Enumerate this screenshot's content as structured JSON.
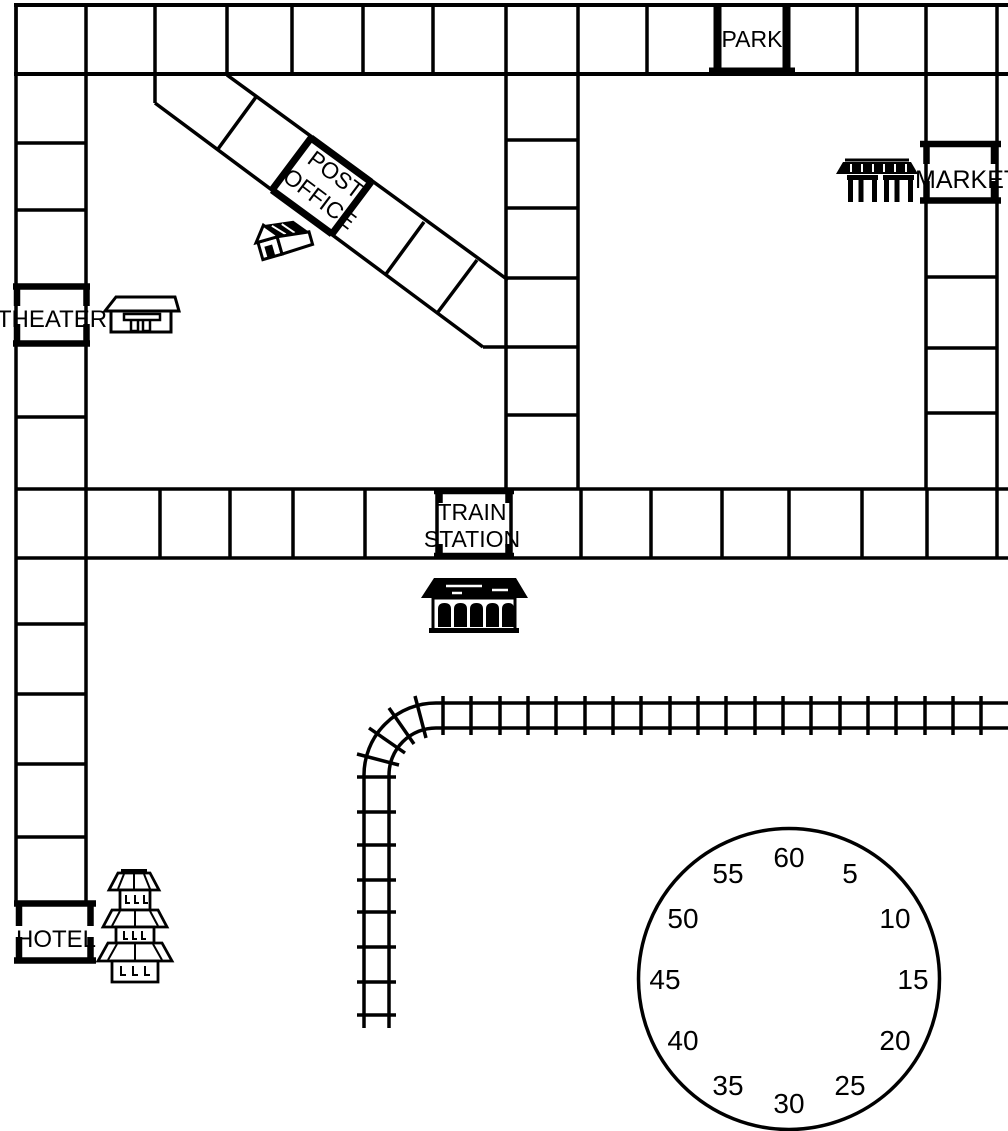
{
  "board": {
    "park_label": "PARK",
    "post_office_line1": "POST",
    "post_office_line2": "OFFICE",
    "market_label": "MARKET",
    "theater_label": "THEATER",
    "train_station_line1": "TRAIN",
    "train_station_line2": "STATION",
    "hotel_label": "HOTEL"
  },
  "timer": {
    "numbers": [
      "60",
      "5",
      "10",
      "15",
      "20",
      "25",
      "30",
      "35",
      "40",
      "45",
      "50",
      "55"
    ]
  },
  "colors": {
    "ink": "#000000",
    "paper": "#ffffff"
  }
}
